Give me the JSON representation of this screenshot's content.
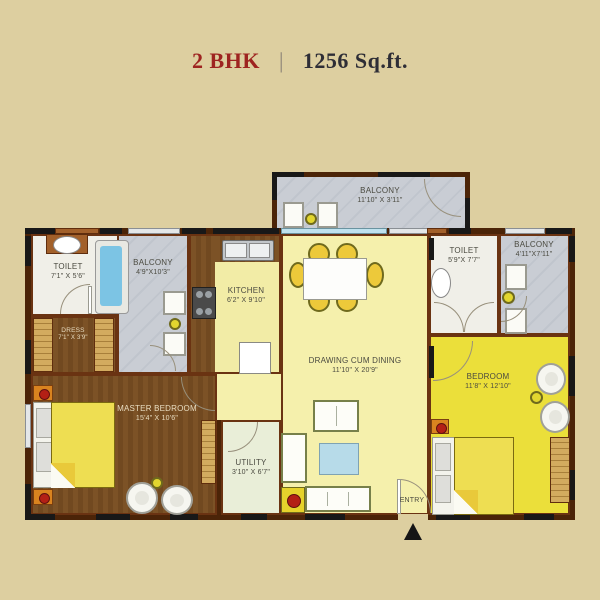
{
  "title": {
    "bhk": "2 BHK",
    "separator": "|",
    "area": "1256 Sq.ft."
  },
  "rooms": {
    "balcony_top": {
      "name": "BALCONY",
      "dim": "11'10\" X 3'11\""
    },
    "toilet_left": {
      "name": "TOILET",
      "dim": "7'1\" X 5'6\""
    },
    "balcony_left": {
      "name": "BALCONY",
      "dim": "4'9\"X10'3\""
    },
    "kitchen": {
      "name": "KITCHEN",
      "dim": "6'2\" X 9'10\""
    },
    "drawing_dining": {
      "name": "DRAWING CUM DINING",
      "dim": "11'10\" X 20'9\""
    },
    "toilet_right": {
      "name": "TOILET",
      "dim": "5'9\"X 7'7\""
    },
    "balcony_right": {
      "name": "BALCONY",
      "dim": "4'11\"X7'11\""
    },
    "dress": {
      "name": "DRESS",
      "dim": "7'1\" X 3'9\""
    },
    "master_bedroom": {
      "name": "MASTER BEDROOM",
      "dim": "15'4\" X 10'6\""
    },
    "utility": {
      "name": "UTILITY",
      "dim": "3'10\" X 6'7\""
    },
    "bedroom": {
      "name": "BEDROOM",
      "dim": "11'8\" X 12'10\""
    },
    "entry_label": "ENTRY"
  },
  "colors": {
    "background": "#ddcfa0",
    "wall": "#4b2408",
    "accent_red": "#9e2420",
    "wood_floor": "#7c5226",
    "bedroom_yellow": "#ebdf3a",
    "hall_yellow": "#f5f0ac",
    "balcony_gray": "#c9cdd4",
    "utility_green": "#e9eed8",
    "tub_blue": "#7cc4e4"
  }
}
